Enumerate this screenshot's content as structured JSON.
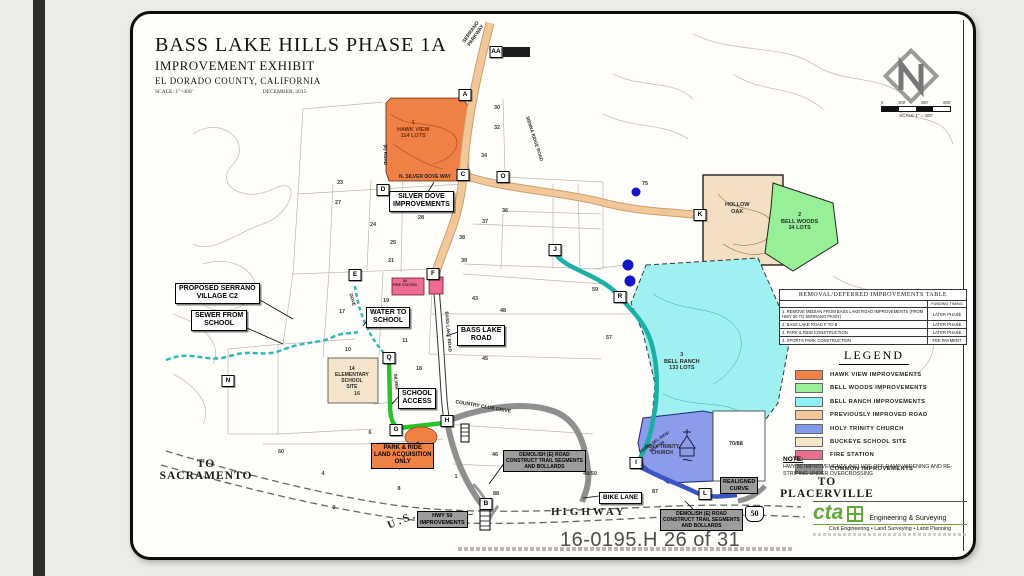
{
  "slide": {
    "page_stamp": "16-0195.H 26 of 31"
  },
  "title_block": {
    "title": "BASS LAKE HILLS PHASE 1A",
    "subtitle": "IMPROVEMENT EXHIBIT",
    "location": "EL DORADO COUNTY,  CALIFORNIA",
    "scale": "SCALE: 1\"=400'",
    "date": "DECEMBER, 2015"
  },
  "north": {
    "scale_bar": {
      "ticks": [
        "0",
        "200'",
        "400'",
        "800'"
      ],
      "caption": "SCALE 1\" = 400'"
    }
  },
  "table": {
    "title": "REMOVAL/DEFERRED IMPROVEMENTS TABLE",
    "col2_header": "FUNDING TIMING",
    "rows": [
      {
        "item": "1. REMOVE MEDIAN FROM BASS LAKE ROAD IMPROVEMENTS (FROM HWY 50 TO SERRANO PKWY)",
        "timing": "LATER PHASE"
      },
      {
        "item": "2. BASS LAKE ROAD F TO B",
        "timing": "LATER PHASE"
      },
      {
        "item": "3. PARK & RIDE CONSTRUCTION",
        "timing": "LATER PHASE"
      },
      {
        "item": "4. SPORTS PARK CONSTRUCTION",
        "timing": "FEE PAYMENT"
      }
    ]
  },
  "legend": {
    "title": "LEGEND",
    "items": [
      {
        "label": "HAWK VIEW IMPROVEMENTS",
        "color": "#EF8147"
      },
      {
        "label": "BELL WOODS IMPROVEMENTS",
        "color": "#97EF97"
      },
      {
        "label": "BELL RANCH IMPROVEMENTS",
        "color": "#8FF2F2"
      },
      {
        "label": "PREVIOUSLY IMPROVED ROAD",
        "color": "#F2C89B"
      },
      {
        "label": "HOLY TRINITY CHURCH",
        "color": "#8099E8"
      },
      {
        "label": "BUCKEYE SCHOOL SITE",
        "color": "#F5E6CB"
      },
      {
        "label": "FIRE STATION",
        "color": "#E8708F"
      },
      {
        "label": "COMMON IMPROVEMENTS",
        "color": "#909090"
      }
    ]
  },
  "note": {
    "heading": "NOTE:",
    "text": "HWY 50 IMPROVEMENTS INCLUDE OFF-RAMP WIDENING AND RE-STRIPING UNDER OVERCROSSING"
  },
  "directions": {
    "to_sacramento": "TO\nSACRAMENTO",
    "to_placerville": "TO\nPLACERVILLE"
  },
  "firm": {
    "name": "cta",
    "tagline": "Engineering & Surveying",
    "services": "Civil Engineering • Land Surveying • Land Planning"
  },
  "map": {
    "highway_shield": "50",
    "markers": [
      {
        "letter": "A",
        "x": 332,
        "y": 81
      },
      {
        "letter": "AA",
        "x": 363,
        "y": 38
      },
      {
        "letter": "B",
        "x": 353,
        "y": 490
      },
      {
        "letter": "C",
        "x": 330,
        "y": 161
      },
      {
        "letter": "D",
        "x": 250,
        "y": 176
      },
      {
        "letter": "E",
        "x": 222,
        "y": 261
      },
      {
        "letter": "F",
        "x": 300,
        "y": 260
      },
      {
        "letter": "G",
        "x": 263,
        "y": 416
      },
      {
        "letter": "H",
        "x": 314,
        "y": 407
      },
      {
        "letter": "I",
        "x": 503,
        "y": 449
      },
      {
        "letter": "J",
        "x": 422,
        "y": 236
      },
      {
        "letter": "K",
        "x": 567,
        "y": 201
      },
      {
        "letter": "L",
        "x": 572,
        "y": 480
      },
      {
        "letter": "N",
        "x": 95,
        "y": 367
      },
      {
        "letter": "O",
        "x": 370,
        "y": 163
      },
      {
        "letter": "Q",
        "x": 256,
        "y": 344
      },
      {
        "letter": "R",
        "x": 487,
        "y": 283
      }
    ],
    "labels": [
      {
        "id": "lbl-silver-dove",
        "text": "SILVER DOVE\nIMPROVEMENTS",
        "x": 256,
        "y": 177,
        "style": "box",
        "fs": 7
      },
      {
        "id": "lbl-proposed-serrano",
        "text": "PROPOSED SERRANO\nVILLAGE C2",
        "x": 42,
        "y": 269,
        "style": "box",
        "fs": 7
      },
      {
        "id": "lbl-sewer-from-school",
        "text": "SEWER FROM\nSCHOOL",
        "x": 58,
        "y": 296,
        "style": "box",
        "fs": 7
      },
      {
        "id": "lbl-water-to-school",
        "text": "WATER TO\nSCHOOL",
        "x": 233,
        "y": 293,
        "style": "box",
        "fs": 7
      },
      {
        "id": "lbl-bass-lake-road",
        "text": "BASS LAKE\nROAD",
        "x": 324,
        "y": 311,
        "style": "box",
        "fs": 7
      },
      {
        "id": "lbl-school-access",
        "text": "SCHOOL\nACCESS",
        "x": 265,
        "y": 374,
        "style": "box",
        "fs": 7
      },
      {
        "id": "lbl-bike-lane",
        "text": "BIKE  LANE",
        "x": 466,
        "y": 478,
        "style": "box",
        "fs": 6.5
      },
      {
        "id": "lbl-realigned-curve",
        "text": "REALIGNED\nCURVE",
        "x": 587,
        "y": 463,
        "style": "gray",
        "fs": 5.5
      },
      {
        "id": "lbl-park-and-ride",
        "text": "PARK & RIDE\nLAND ACQUISITION\nONLY",
        "x": 238,
        "y": 429,
        "style": "orange",
        "fs": 6
      },
      {
        "id": "lbl-demolish-road-west",
        "text": "DEMOLISH (E) ROAD\nCONSTRUCT TRAIL SEGMENTS\nAND BOLLARDS",
        "x": 370,
        "y": 436,
        "style": "gray",
        "fs": 5
      },
      {
        "id": "lbl-demolish-road-east",
        "text": "DEMOLISH (E) ROAD\nCONSTRUCT TRAIL SEGMENTS\nAND BOLLARDS",
        "x": 527,
        "y": 495,
        "style": "gray",
        "fs": 5
      },
      {
        "id": "lbl-hwy50-improvements",
        "text": "HWY 50\nIMPROVEMENTS",
        "x": 284,
        "y": 497,
        "style": "gray",
        "fs": 5.5
      },
      {
        "id": "lbl-fire-station",
        "text": "80\nFIRE STATION",
        "x": 260,
        "y": 265,
        "style": "plain",
        "fs": 3.5
      },
      {
        "id": "lbl-hawk-view",
        "text": "1\nHAWK VIEW\n114 LOTS",
        "x": 264,
        "y": 106,
        "style": "plain",
        "cls": "dark-red",
        "fs": 5.5
      },
      {
        "id": "lbl-hollow-oak",
        "text": "HOLLOW\nOAK",
        "x": 592,
        "y": 188,
        "style": "plain",
        "fs": 5.5
      },
      {
        "id": "lbl-bell-woods",
        "text": "2\nBELL WOODS\n34 LOTS",
        "x": 648,
        "y": 198,
        "style": "plain",
        "fs": 5.5
      },
      {
        "id": "lbl-bell-ranch",
        "text": "3\nBELL RANCH\n133 LOTS",
        "x": 531,
        "y": 338,
        "style": "plain",
        "fs": 5.5
      },
      {
        "id": "lbl-holy-trinity",
        "text": "HOLY TRINITY\nCHURCH",
        "x": 512,
        "y": 430,
        "style": "plain",
        "fs": 5
      },
      {
        "id": "lbl-70-88",
        "text": "70/88",
        "x": 596,
        "y": 427,
        "style": "plain",
        "fs": 5.5
      },
      {
        "id": "lbl-elementary-school",
        "text": "14\nELEMENTARY\nSCHOOL\nSITE",
        "x": 202,
        "y": 352,
        "style": "plain",
        "fs": 5
      },
      {
        "id": "lbl-us",
        "text": "U.S.",
        "x": 254,
        "y": 500,
        "style": "serif-road",
        "rot": -22,
        "fs": 11
      },
      {
        "id": "lbl-highway",
        "text": "HIGHWAY",
        "x": 418,
        "y": 492,
        "style": "serif-road",
        "fs": 11
      },
      {
        "id": "lbl-serrano-parkway",
        "text": "SERRANO\nPARKWAY",
        "x": 328,
        "y": 14,
        "style": "road",
        "rot": -55,
        "fs": 5
      },
      {
        "id": "lbl-n-silver-dove-way",
        "text": "N. SILVER DOVE WAY",
        "x": 266,
        "y": 160,
        "style": "road",
        "fs": 5
      },
      {
        "id": "lbl-sienna-ridge-road",
        "text": "SIENNA RIDGE ROAD",
        "x": 378,
        "y": 122,
        "style": "road",
        "rot": 72,
        "fs": 4.5
      },
      {
        "id": "lbl-country-club-drive",
        "text": "COUNTRY CLUB DRIVE",
        "x": 322,
        "y": 390,
        "style": "road",
        "rot": 10,
        "fs": 5
      },
      {
        "id": "lbl-bass-lake-road-vert",
        "text": "BASS LAKE ROAD",
        "x": 295,
        "y": 315,
        "style": "road",
        "rot": 85,
        "fs": 4.5
      },
      {
        "id": "lbl-silver-vert",
        "text": "SILVER",
        "x": 255,
        "y": 365,
        "style": "road",
        "rot": 85,
        "fs": 4.5
      },
      {
        "id": "lbl-e-road",
        "text": "(E) ROAD",
        "x": 242,
        "y": 138,
        "style": "road",
        "rot": 90,
        "fs": 4.5
      },
      {
        "id": "lbl-dove",
        "text": "DOVE",
        "x": 213,
        "y": 283,
        "style": "road",
        "rot": 75,
        "fs": 4.5
      },
      {
        "id": "lbl-tierra-del-dios",
        "text": "TIERRA DEL DIOS/\nMISSION",
        "x": 505,
        "y": 426,
        "style": "road",
        "rot": -35,
        "fs": 4
      }
    ],
    "parcel_numbers": [
      {
        "n": "23",
        "x": 207,
        "y": 169
      },
      {
        "n": "27",
        "x": 205,
        "y": 189
      },
      {
        "n": "24",
        "x": 240,
        "y": 211
      },
      {
        "n": "25",
        "x": 260,
        "y": 229
      },
      {
        "n": "21",
        "x": 258,
        "y": 247
      },
      {
        "n": "28",
        "x": 288,
        "y": 204
      },
      {
        "n": "30",
        "x": 364,
        "y": 94
      },
      {
        "n": "32",
        "x": 364,
        "y": 114
      },
      {
        "n": "34",
        "x": 351,
        "y": 142
      },
      {
        "n": "36",
        "x": 372,
        "y": 197
      },
      {
        "n": "37",
        "x": 352,
        "y": 208
      },
      {
        "n": "38",
        "x": 329,
        "y": 224
      },
      {
        "n": "39",
        "x": 331,
        "y": 247
      },
      {
        "n": "43",
        "x": 342,
        "y": 285
      },
      {
        "n": "45",
        "x": 352,
        "y": 345
      },
      {
        "n": "48",
        "x": 370,
        "y": 297
      },
      {
        "n": "17",
        "x": 209,
        "y": 298
      },
      {
        "n": "19",
        "x": 253,
        "y": 287
      },
      {
        "n": "11",
        "x": 272,
        "y": 327
      },
      {
        "n": "10",
        "x": 215,
        "y": 336
      },
      {
        "n": "18",
        "x": 286,
        "y": 355
      },
      {
        "n": "16",
        "x": 224,
        "y": 380
      },
      {
        "n": "6",
        "x": 237,
        "y": 419
      },
      {
        "n": "7",
        "x": 267,
        "y": 455
      },
      {
        "n": "8",
        "x": 266,
        "y": 475
      },
      {
        "n": "1",
        "x": 323,
        "y": 463
      },
      {
        "n": "46",
        "x": 362,
        "y": 441
      },
      {
        "n": "48/50",
        "x": 457,
        "y": 460
      },
      {
        "n": "88",
        "x": 363,
        "y": 480
      },
      {
        "n": "87",
        "x": 522,
        "y": 478
      },
      {
        "n": "57",
        "x": 476,
        "y": 324
      },
      {
        "n": "59",
        "x": 462,
        "y": 276
      },
      {
        "n": "60",
        "x": 148,
        "y": 438
      },
      {
        "n": "4",
        "x": 190,
        "y": 460
      },
      {
        "n": "3",
        "x": 201,
        "y": 494
      },
      {
        "n": "75",
        "x": 512,
        "y": 170
      }
    ]
  }
}
